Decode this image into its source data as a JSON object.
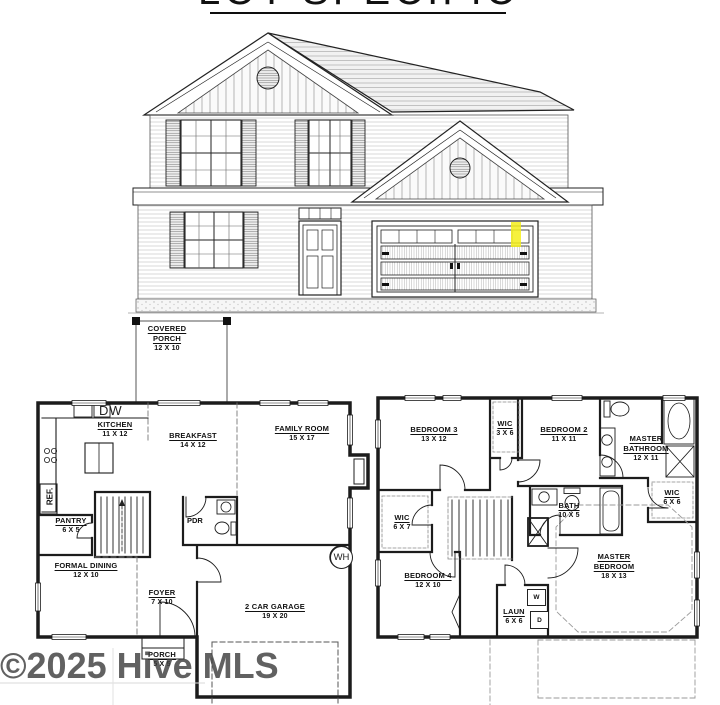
{
  "title": "LOT SPECIFIC",
  "watermark": "©2025 Hive MLS",
  "covered_porch": {
    "name": "COVERED PORCH",
    "dims": "12 X 10"
  },
  "floor1": {
    "dw": "DW",
    "ref": "REF.",
    "kitchen": {
      "name": "KITCHEN",
      "dims": "11 X 12"
    },
    "breakfast": {
      "name": "BREAKFAST",
      "dims": "14 X 12"
    },
    "family_room": {
      "name": "FAMILY ROOM",
      "dims": "15 X 17"
    },
    "pantry": {
      "name": "PANTRY",
      "dims": "6 X 5"
    },
    "pdr": "PDR",
    "formal_dining": {
      "name": "FORMAL DINING",
      "dims": "12 X 10"
    },
    "foyer": {
      "name": "FOYER",
      "dims": "7 X 10"
    },
    "garage": {
      "name": "2 CAR GARAGE",
      "dims": "19 X 20"
    },
    "wh": "WH",
    "porch": {
      "name": "PORCH",
      "dims": "5 X 5"
    }
  },
  "floor2": {
    "bedroom3": {
      "name": "BEDROOM 3",
      "dims": "13 X 12"
    },
    "wic_hall": {
      "name": "WIC",
      "dims": "3 X 6"
    },
    "bedroom2": {
      "name": "BEDROOM 2",
      "dims": "11 X 11"
    },
    "master_bathroom": {
      "name": "MASTER BATHROOM",
      "dims": "12 X 11"
    },
    "wic_master": {
      "name": "WIC",
      "dims": "6 X 6"
    },
    "bath": {
      "name": "BATH",
      "dims": "10 X 5"
    },
    "wic_left": {
      "name": "WIC",
      "dims": "6 X 7"
    },
    "bedroom4": {
      "name": "BEDROOM 4",
      "dims": "12 X 10"
    },
    "laundry": {
      "name": "LAUN",
      "dims": "6 X 6",
      "washer": "W",
      "dryer": "D"
    },
    "master_bedroom": {
      "name": "MASTER BEDROOM",
      "dims": "18 X 13"
    }
  },
  "colors": {
    "highlight": "#f4ef1b",
    "line": "#1c1c1c",
    "watermark": "#3f3f3f"
  }
}
